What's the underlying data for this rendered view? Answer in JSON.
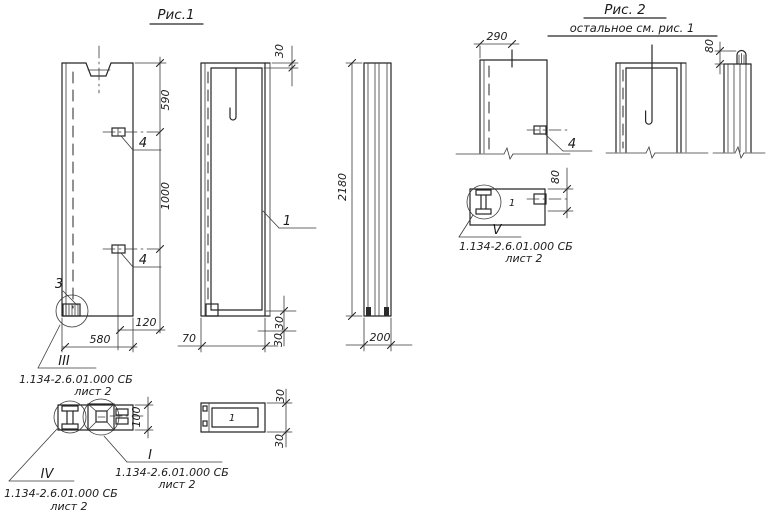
{
  "fig1": {
    "title": "Рис.1",
    "front_view": {
      "dim_590": "590",
      "dim_1000": "1000",
      "embed_top_label": "4",
      "embed_bottom_label": "4",
      "corner_detail_label": "3",
      "dim_120": "120",
      "dim_580": "580"
    },
    "face_view": {
      "dim_30_top": "30",
      "panel_mark": "1",
      "dim_70": "70",
      "dim_30_bottom_upper": "30",
      "dim_30_bottom_lower": "30"
    },
    "side_view": {
      "dim_2180": "2180",
      "dim_200": "200"
    },
    "end_view": {
      "dim_100": "100"
    },
    "plan_view": {
      "panel_mark": "1",
      "dim_30_top": "30",
      "dim_30_bottom": "30"
    },
    "callout_3": {
      "numeral": "III",
      "doc": "1.134-2.6.01.000 СБ",
      "sheet": "лист 2"
    },
    "callout_4": {
      "numeral": "IV",
      "doc": "1.134-2.6.01.000 СБ",
      "sheet": "лист 2"
    },
    "callout_1": {
      "numeral": "I",
      "doc": "1.134-2.6.01.000 СБ",
      "sheet": "лист 2"
    }
  },
  "fig2": {
    "title": "Рис. 2",
    "subtitle": "остальное см. рис. 1",
    "front_view": {
      "dim_290": "290",
      "embed_label": "4"
    },
    "side_view": {
      "dim_80": "80"
    },
    "detail_view": {
      "dim_80": "80",
      "panel_mark": "1"
    },
    "callout_5": {
      "numeral": "V",
      "doc": "1.134-2.6.01.000 СБ",
      "sheet": "лист 2"
    }
  }
}
